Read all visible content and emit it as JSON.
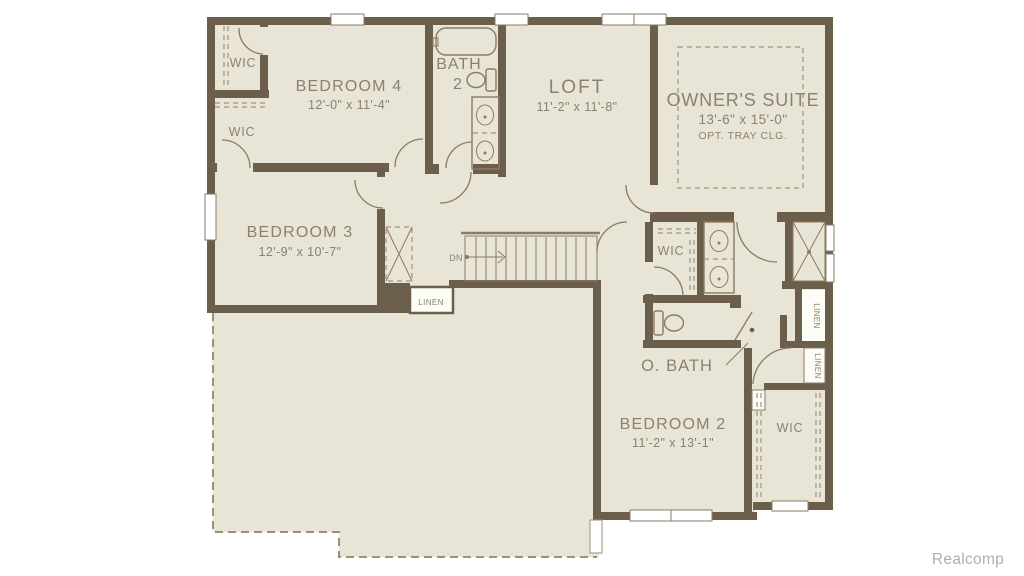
{
  "watermark": "Realcomp",
  "colors": {
    "background": "#ffffff",
    "floor": "#e8e4d6",
    "wall": "#6b5e4b",
    "fixture_line": "#8a7b63",
    "label_text": "#8b8170",
    "dashed_line": "#a1937c",
    "watermark_text": "#b1afac"
  },
  "rooms": {
    "wic_bedroom4": {
      "label": "WIC"
    },
    "wic_bedroom3": {
      "label": "WIC"
    },
    "bedroom4": {
      "label": "BEDROOM 4",
      "dims": "12'-0\" x 11'-4\""
    },
    "bath2": {
      "line1": "BATH",
      "line2": "2"
    },
    "loft": {
      "label": "LOFT",
      "dims": "11'-2\" x 11'-8\""
    },
    "owners_suite": {
      "label": "OWNER'S SUITE",
      "dims": "13'-6\" x 15'-0\"",
      "note": "OPT. TRAY CLG."
    },
    "bedroom3": {
      "label": "BEDROOM 3",
      "dims": "12'-9\" x 10'-7\""
    },
    "stairs": {
      "label": "DN"
    },
    "linen_hall": {
      "label": "LINEN"
    },
    "wic_owner": {
      "label": "WIC"
    },
    "linen_upper": {
      "label": "LINEN"
    },
    "linen_lower": {
      "label": "LINEN"
    },
    "owners_bath": {
      "label": "O. BATH"
    },
    "bedroom2": {
      "label": "BEDROOM 2",
      "dims": "11'-2\" x 13'-1\""
    },
    "wic_bedroom2": {
      "label": "WIC"
    }
  }
}
